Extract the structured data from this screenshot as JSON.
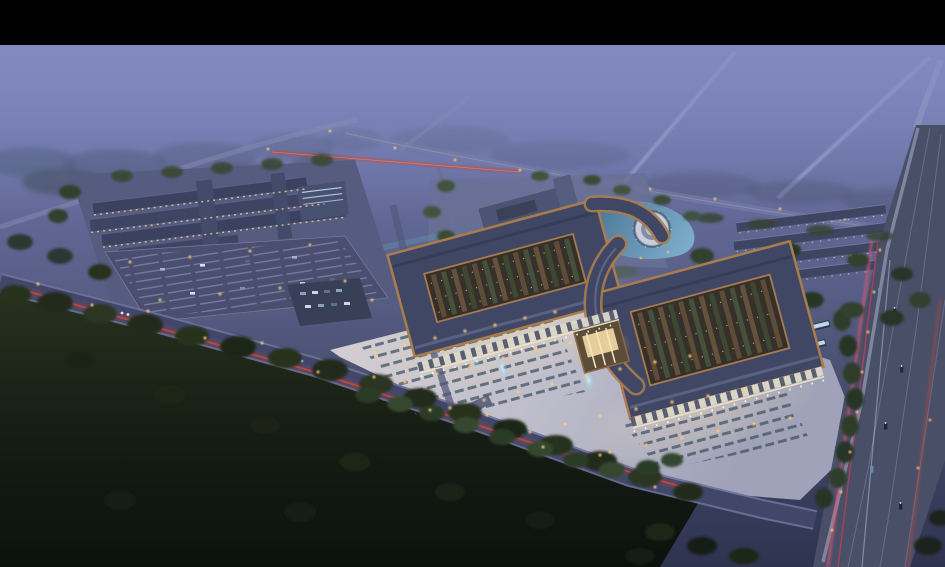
{
  "meta": {
    "description": "Night-time aerial architectural rendering: a large Chinese-style trade-market campus with two grand curved-roof exhibition halls around open stall courtyards, a glowing front plaza with parking rows and fountains, a secondary warehouse campus with parking lot at left, a small office cluster, pond and circular fountain plaza behind, rows of long outbuildings at right, all wrapped by dark tree belts, fields and roads carrying red and pink vehicle light trails under a purple dusk haze. Black letterbox bar across the top.",
    "image_kind": "architectural-aerial-rendering",
    "visible_text": ""
  },
  "frame": {
    "letterbox_color": "#000000",
    "letterbox_top_px": 45
  },
  "palette": {
    "haze_top": "#828ac0",
    "haze_mid": "#6e76aa",
    "ground_purple": "#565c82",
    "field_dark": "#0e130e",
    "tree_dark": "#20291e",
    "tree_mid": "#2e3d2c",
    "tree_lit": "#40523c",
    "road": "#474c66",
    "road_edge": "#757ba0",
    "highway": "#4a4f68",
    "taillight_red": "#d9442e",
    "trail_pink": "#e0566e",
    "headlight_white": "#dfe6f5",
    "streetlight_warm": "#ffd9a0",
    "window_warm": "#ecd5a0",
    "roof_slate": "#3f4764",
    "roof_trim": "#aa7c4c",
    "courtyard_dark": "#35302a",
    "stall_brown": "#5e4c38",
    "stall_green": "#46503a",
    "plaza_light": "#c7c5d2",
    "plaza_warm": "#e7d6b8",
    "parking_strip": "#3e5062",
    "water": "#55809e",
    "fountain_blue": "#bfe4f2",
    "colonnade_white": "#ddd8ca"
  },
  "scene": {
    "regions": [
      "letterbox-top",
      "dusk-haze-sky",
      "distant-roads",
      "upper-road-with-taillights",
      "left-warehouse-campus",
      "campus-parking-lot",
      "office-cluster",
      "pond",
      "circular-plaza",
      "right-outbuilding-rows",
      "main-hall-left",
      "main-hall-right",
      "central-gate",
      "front-colonnades",
      "front-plaza",
      "plaza-parking-rows",
      "fountains",
      "main-diagonal-road",
      "right-highway",
      "light-trails",
      "tree-belts",
      "dark-fields"
    ]
  }
}
